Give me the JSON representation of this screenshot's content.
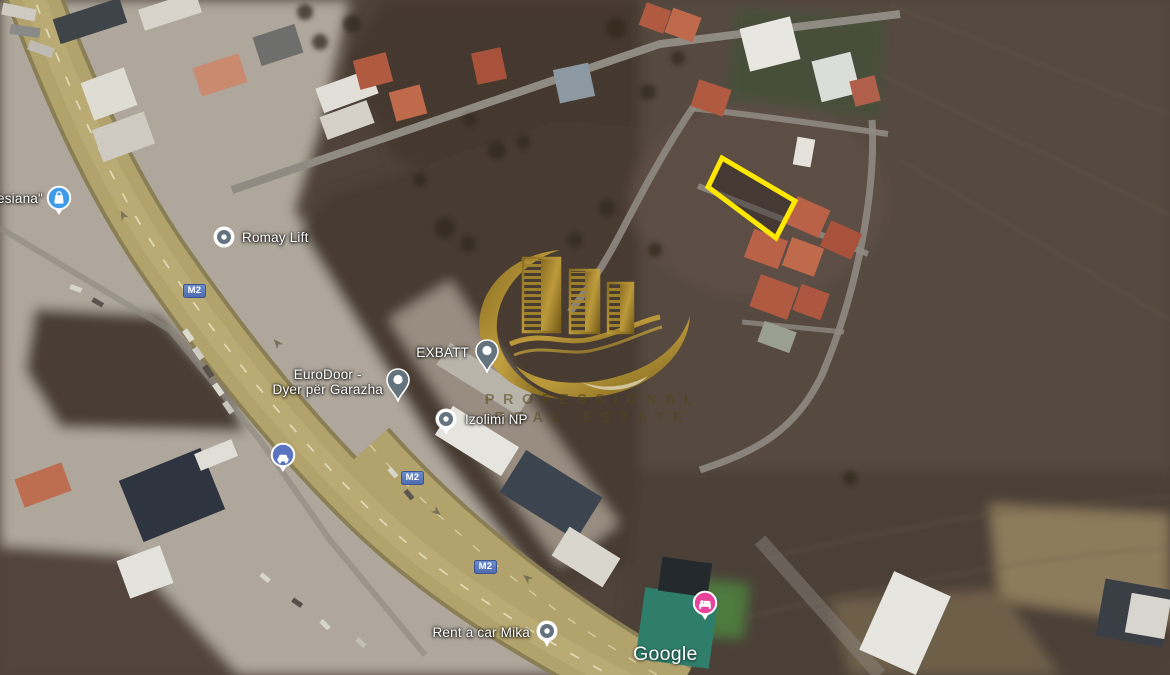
{
  "map": {
    "place_labels": [
      {
        "text": "esiana\""
      },
      {
        "text": "Romay Lift"
      },
      {
        "text": "EXBATT"
      },
      {
        "text": "EuroDoor -",
        "text2": "Dyer për Garazha"
      },
      {
        "text": "Izolimi NP"
      },
      {
        "text": "Rent a car Mika"
      }
    ],
    "road_shield_label": "M2",
    "google_watermark": "Google"
  },
  "markers": [
    {
      "id": "shopping-pin",
      "icon": "shopping-bag-icon",
      "color": "#3D9BE9"
    },
    {
      "id": "romay-dot",
      "icon": "poi-dot-icon",
      "color": "#64737D"
    },
    {
      "id": "exbatt-pin",
      "icon": "map-pin-icon",
      "color": "#64737D"
    },
    {
      "id": "eurodoor-pin",
      "icon": "map-pin-icon",
      "color": "#64737D"
    },
    {
      "id": "izolimi-dot",
      "icon": "poi-dot-icon",
      "color": "#64737D"
    },
    {
      "id": "car-dealer-pin",
      "icon": "car-icon",
      "color": "#5A74C2"
    },
    {
      "id": "rentacar-dot",
      "icon": "poi-dot-icon",
      "color": "#64737D"
    },
    {
      "id": "lodging-pin",
      "icon": "bed-icon",
      "color": "#E8439A"
    }
  ],
  "plot_highlight": {
    "points": "722,158 795,201 776,238 708,187",
    "outline_color": "#FFE800"
  },
  "logo_watermark": {
    "line1": "PROFESSIONAL",
    "line2": "REAL ESTATE",
    "gold_color": "#A8882C"
  },
  "colors": {
    "label_text": "#FFFFFF",
    "road_shield_bg": "#5877BE",
    "pin_slate": "#64737D",
    "highway_tan": "#B3A46E",
    "field_dark": "#4E423A",
    "industrial_light": "#AFA79B"
  }
}
